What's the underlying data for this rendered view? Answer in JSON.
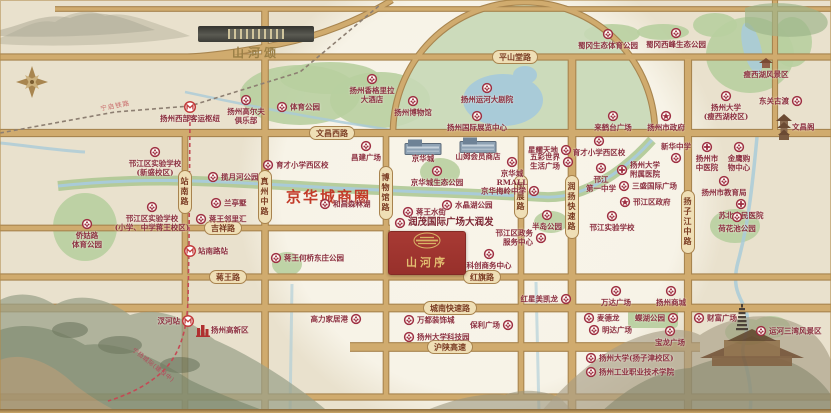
{
  "project": {
    "name": "山河序"
  },
  "sister_project": {
    "name": "山河颂"
  },
  "business_circle": {
    "label": "京华城商圈"
  },
  "rail": {
    "label": "宁启铁路"
  },
  "metro": {
    "label": "宁扬城际(建设中)"
  },
  "colors": {
    "road_fill": "#d0ab6e",
    "road_edge": "#a8854f",
    "park": "#b8cfa0",
    "water": "#a9cbd8",
    "accent_red": "#9e2f42",
    "project_box": "#a23530",
    "gold": "#c9a86a",
    "biz_text": "#c23a28"
  },
  "roads_h": [
    {
      "y": 9,
      "x1": 55,
      "x2": 831,
      "w": 3.5,
      "labels": []
    },
    {
      "y": 57,
      "x1": 0,
      "x2": 831,
      "w": 5,
      "labels": [
        {
          "text": "平山堂路",
          "x": 515
        }
      ]
    },
    {
      "y": 133,
      "x1": 0,
      "x2": 831,
      "w": 6,
      "labels": [
        {
          "text": "文昌西路",
          "x": 332
        }
      ]
    },
    {
      "y": 228,
      "x1": 0,
      "x2": 390,
      "w": 4.5,
      "labels": [
        {
          "text": "吉祥路",
          "x": 223
        }
      ]
    },
    {
      "y": 277,
      "x1": 0,
      "x2": 831,
      "w": 5,
      "labels": [
        {
          "text": "蒋王路",
          "x": 228
        },
        {
          "text": "红旗路",
          "x": 482
        }
      ]
    },
    {
      "y": 308,
      "x1": 0,
      "x2": 831,
      "w": 6.5,
      "labels": [
        {
          "text": "城南快速路",
          "x": 450
        }
      ]
    },
    {
      "y": 347,
      "x1": 350,
      "x2": 700,
      "w": 7.5,
      "labels": [
        {
          "text": "沪陕高速",
          "x": 450
        }
      ]
    },
    {
      "y": 397,
      "x1": 0,
      "x2": 831,
      "w": 5,
      "labels": []
    }
  ],
  "roads_v": [
    {
      "x": 185,
      "y1": 133,
      "y2": 413,
      "w": 4.5,
      "labels": [
        {
          "text": "站南路",
          "y": 192
        }
      ]
    },
    {
      "x": 265,
      "y1": 9,
      "y2": 413,
      "w": 5.5,
      "labels": [
        {
          "text": "真州中路",
          "y": 197
        }
      ]
    },
    {
      "x": 386,
      "y1": 133,
      "y2": 397,
      "w": 4.5,
      "labels": [
        {
          "text": "博物馆路",
          "y": 193
        }
      ]
    },
    {
      "x": 521,
      "y1": 133,
      "y2": 397,
      "w": 4.5,
      "labels": [
        {
          "text": "国展路",
          "y": 197
        }
      ]
    },
    {
      "x": 572,
      "y1": 57,
      "y2": 413,
      "w": 6.5,
      "labels": [
        {
          "text": "润扬快速路",
          "y": 207
        }
      ]
    },
    {
      "x": 688,
      "y1": 57,
      "y2": 413,
      "w": 6,
      "labels": [
        {
          "text": "扬子江中路",
          "y": 222
        }
      ]
    },
    {
      "x": 775,
      "y1": 0,
      "y2": 133,
      "w": 4,
      "labels": []
    }
  ],
  "pois": [
    {
      "x": 190,
      "y": 107,
      "t": "扬州西部客运枢纽",
      "p": "b",
      "i": "m"
    },
    {
      "x": 246,
      "y": 100,
      "t": "扬州高尔夫\n俱乐部",
      "p": "b",
      "i": "f"
    },
    {
      "x": 282,
      "y": 107,
      "t": "体育公园",
      "p": "r",
      "i": "f"
    },
    {
      "x": 372,
      "y": 79,
      "t": "扬州香格里拉\n大酒店",
      "p": "b",
      "i": "f"
    },
    {
      "x": 413,
      "y": 101,
      "t": "扬州博物馆",
      "p": "b",
      "i": "f"
    },
    {
      "x": 487,
      "y": 88,
      "t": "扬州运河大剧院",
      "p": "b",
      "i": "f"
    },
    {
      "x": 477,
      "y": 116,
      "t": "扬州国际展览中心",
      "p": "b",
      "i": "f"
    },
    {
      "x": 608,
      "y": 34,
      "t": "蜀冈生态体育公园",
      "p": "b",
      "i": "f"
    },
    {
      "x": 676,
      "y": 33,
      "t": "蜀冈西峰生态公园",
      "p": "b",
      "i": "f"
    },
    {
      "x": 766,
      "y": 63,
      "t": "瘦西湖风景区",
      "p": "b",
      "i": "temple"
    },
    {
      "x": 726,
      "y": 96,
      "t": "扬州大学\n(瘦西湖校区)",
      "p": "b",
      "i": "f"
    },
    {
      "x": 797,
      "y": 101,
      "t": "东关古渡",
      "p": "l",
      "i": "f"
    },
    {
      "x": 784,
      "y": 127,
      "t": "文昌阁",
      "p": "r",
      "i": "pagoda"
    },
    {
      "x": 613,
      "y": 116,
      "t": "来鹤台广场",
      "p": "b",
      "i": "f"
    },
    {
      "x": 666,
      "y": 116,
      "t": "扬州市政府",
      "p": "b",
      "i": "s"
    },
    {
      "x": 155,
      "y": 152,
      "t": "邗江区实验学校\n(新盛校区)",
      "p": "b",
      "i": "f"
    },
    {
      "x": 152,
      "y": 207,
      "t": "邗江区实验学校\n(小学、中学蒋王校区)",
      "p": "b",
      "i": "f"
    },
    {
      "x": 87,
      "y": 224,
      "t": "侨姑路\n体育公园",
      "p": "b",
      "i": "f"
    },
    {
      "x": 213,
      "y": 177,
      "t": "揽月河公园",
      "p": "r",
      "i": "f"
    },
    {
      "x": 216,
      "y": 203,
      "t": "兰亭墅",
      "p": "r",
      "i": "f"
    },
    {
      "x": 201,
      "y": 219,
      "t": "蒋王邻里汇",
      "p": "r",
      "i": "f"
    },
    {
      "x": 190,
      "y": 251,
      "t": "站南路站",
      "p": "r",
      "i": "m"
    },
    {
      "x": 268,
      "y": 165,
      "t": "育才小学西区校",
      "p": "r",
      "i": "f"
    },
    {
      "x": 325,
      "y": 204,
      "t": "和昌森林湖",
      "p": "r",
      "i": "f"
    },
    {
      "x": 366,
      "y": 146,
      "t": "昌建广场",
      "p": "b",
      "i": "f"
    },
    {
      "x": 423,
      "y": 147,
      "t": "京华城",
      "p": "b",
      "i": "mall"
    },
    {
      "x": 478,
      "y": 145,
      "t": "山姆会员商店",
      "p": "b",
      "i": "mall"
    },
    {
      "x": 512,
      "y": 162,
      "t": "京华城\nRMALL",
      "p": "b",
      "i": "f"
    },
    {
      "x": 437,
      "y": 171,
      "t": "京华城生态公园",
      "p": "b",
      "i": "f"
    },
    {
      "x": 534,
      "y": 191,
      "t": "京华梅岭中学",
      "p": "l",
      "i": "f"
    },
    {
      "x": 447,
      "y": 205,
      "t": "水晶湖公园",
      "p": "r",
      "i": "f"
    },
    {
      "x": 408,
      "y": 212,
      "t": "蒋王水街",
      "p": "r",
      "i": "f"
    },
    {
      "x": 400,
      "y": 223,
      "t": "润茂国际广场大润发",
      "p": "r",
      "i": "f",
      "big": true
    },
    {
      "x": 541,
      "y": 238,
      "t": "邗江区政务\n服务中心",
      "p": "l",
      "i": "f"
    },
    {
      "x": 489,
      "y": 254,
      "t": "科创商务中心",
      "p": "b",
      "i": "f"
    },
    {
      "x": 566,
      "y": 150,
      "t": "星耀天地",
      "p": "l",
      "i": "f"
    },
    {
      "x": 568,
      "y": 162,
      "t": "五彩世界\n生活广场",
      "p": "l",
      "i": "f"
    },
    {
      "x": 547,
      "y": 215,
      "t": "半岛公园",
      "p": "b",
      "i": "f"
    },
    {
      "x": 599,
      "y": 141,
      "t": "育才小学西区校",
      "p": "b",
      "i": "f"
    },
    {
      "x": 601,
      "y": 168,
      "t": "邗江\n第一中学",
      "p": "b",
      "i": "f"
    },
    {
      "x": 676,
      "y": 158,
      "t": "新华中学",
      "p": "t",
      "i": "f"
    },
    {
      "x": 622,
      "y": 170,
      "t": "扬州大学\n附属医院",
      "p": "r",
      "i": "c"
    },
    {
      "x": 624,
      "y": 186,
      "t": "三盛国际广场",
      "p": "r",
      "i": "f"
    },
    {
      "x": 625,
      "y": 202,
      "t": "邗江区政府",
      "p": "r",
      "i": "s"
    },
    {
      "x": 612,
      "y": 216,
      "t": "邗江实验学校",
      "p": "b",
      "i": "f"
    },
    {
      "x": 707,
      "y": 147,
      "t": "扬州市\n中医院",
      "p": "b",
      "i": "c"
    },
    {
      "x": 739,
      "y": 147,
      "t": "金鹰购\n物中心",
      "p": "b",
      "i": "f"
    },
    {
      "x": 724,
      "y": 181,
      "t": "扬州市教育局",
      "p": "b",
      "i": "f"
    },
    {
      "x": 741,
      "y": 204,
      "t": "苏北人民医院",
      "p": "b",
      "i": "c"
    },
    {
      "x": 737,
      "y": 217,
      "t": "荷花池公园",
      "p": "b",
      "i": "f"
    },
    {
      "x": 566,
      "y": 299,
      "t": "红星美凯龙",
      "p": "l",
      "i": "f"
    },
    {
      "x": 356,
      "y": 319,
      "t": "高力家居港",
      "p": "l",
      "i": "f"
    },
    {
      "x": 409,
      "y": 320,
      "t": "万都装饰城",
      "p": "r",
      "i": "f"
    },
    {
      "x": 508,
      "y": 325,
      "t": "保利广场",
      "p": "l",
      "i": "f"
    },
    {
      "x": 409,
      "y": 337,
      "t": "扬州大学科技园",
      "p": "r",
      "i": "f"
    },
    {
      "x": 616,
      "y": 291,
      "t": "万达广场",
      "p": "b",
      "i": "f"
    },
    {
      "x": 671,
      "y": 291,
      "t": "扬州商城",
      "p": "b",
      "i": "f"
    },
    {
      "x": 589,
      "y": 318,
      "t": "麦德龙",
      "p": "r",
      "i": "f"
    },
    {
      "x": 673,
      "y": 318,
      "t": "蝶湖公园",
      "p": "l",
      "i": "f"
    },
    {
      "x": 594,
      "y": 330,
      "t": "明达广场",
      "p": "r",
      "i": "f"
    },
    {
      "x": 670,
      "y": 331,
      "t": "宝龙广场",
      "p": "b",
      "i": "f"
    },
    {
      "x": 699,
      "y": 318,
      "t": "财富广场",
      "p": "r",
      "i": "f"
    },
    {
      "x": 761,
      "y": 331,
      "t": "运河三湾风景区",
      "p": "r",
      "i": "f"
    },
    {
      "x": 591,
      "y": 358,
      "t": "扬州大学(扬子津校区)",
      "p": "r",
      "i": "f"
    },
    {
      "x": 591,
      "y": 372,
      "t": "扬州工业职业技术学院",
      "p": "r",
      "i": "f"
    },
    {
      "x": 188,
      "y": 321,
      "t": "汊河站",
      "p": "l",
      "i": "m"
    },
    {
      "x": 203,
      "y": 330,
      "t": "扬州高新区",
      "p": "r",
      "i": "hq"
    },
    {
      "x": 276,
      "y": 258,
      "t": "蒋王何桥东庄公园",
      "p": "r",
      "i": "f"
    }
  ]
}
